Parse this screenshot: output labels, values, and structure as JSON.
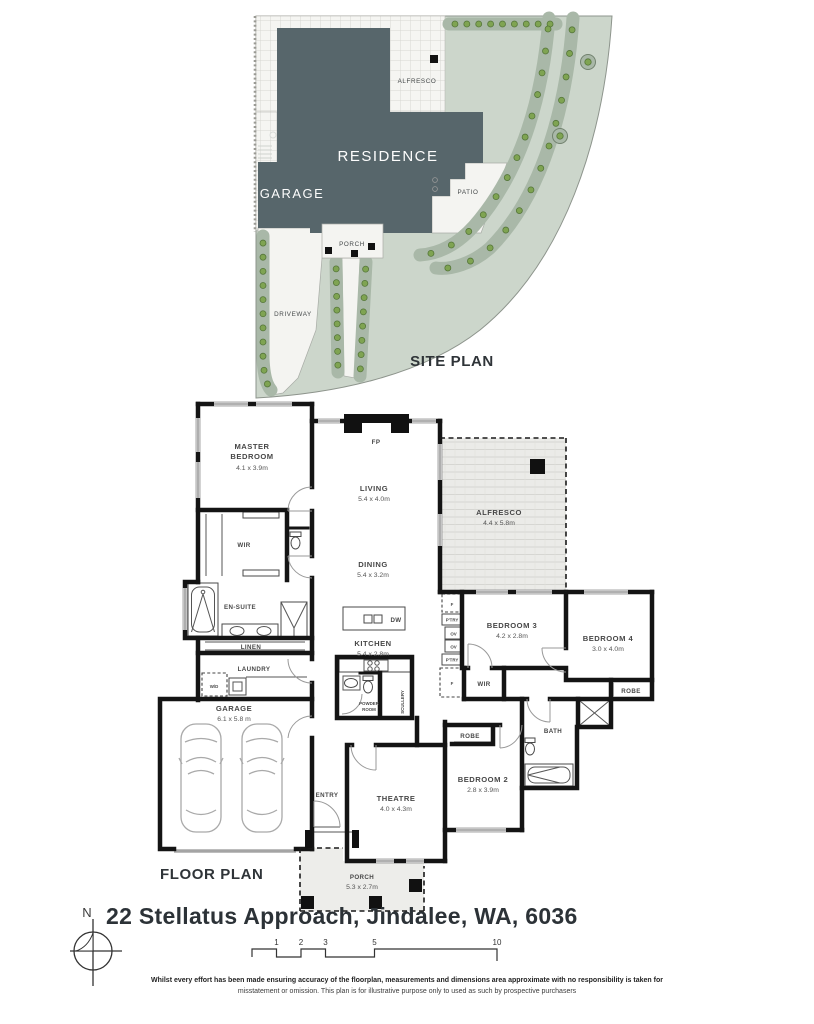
{
  "site": {
    "title": "SITE PLAN",
    "labels": {
      "alfresco": "ALFRESCO",
      "residence": "RESIDENCE",
      "garage": "GARAGE",
      "patio": "PATIO",
      "porch": "PORCH",
      "driveway": "DRIVEWAY"
    }
  },
  "floor": {
    "title": "FLOOR PLAN",
    "labels": {
      "master1": "MASTER",
      "master2": "BEDROOM",
      "master_d": "4.1 x 3.9m",
      "wir": "WIR",
      "ensuite": "EN-SUITE",
      "linen": "LINEN",
      "laundry": "LAUNDRY",
      "wd": "W/D",
      "garage": "GARAGE",
      "garage_d": "6.1 x 5.8 m",
      "living": "LIVING",
      "living_d": "5.4 x 4.0m",
      "dining": "DINING",
      "dining_d": "5.4 x 3.2m",
      "kitchen": "KITCHEN",
      "kitchen_d": "5.4 x 2.8m",
      "dw": "DW",
      "fp": "FP",
      "powder1": "POWDER",
      "powder2": "ROOM",
      "scullery": "SCULLERY",
      "alfresco": "ALFRESCO",
      "alfresco_d": "4.4 x 5.8m",
      "bed3": "BEDROOM 3",
      "bed3_d": "4.2 x 2.8m",
      "bed4": "BEDROOM 4",
      "bed4_d": "3.0 x 4.0m",
      "robe4": "ROBE",
      "f_top": "F",
      "ptry_top": "P'TRY",
      "ov1": "OV",
      "ov2": "OV",
      "ptry_bot": "P'TRY",
      "f_bot": "F",
      "wir2": "WIR",
      "bath": "BATH",
      "robe2": "ROBE",
      "bed2": "BEDROOM 2",
      "bed2_d": "2.8 x 3.9m",
      "entry": "ENTRY",
      "theatre": "THEATRE",
      "theatre_d": "4.0 x 4.3m",
      "porch": "PORCH",
      "porch_d": "5.3 x 2.7m"
    }
  },
  "footer": {
    "north": "N",
    "address": "22 Stellatus Approach, Jindalee, WA, 6036",
    "scale_ticks": [
      "1",
      "2",
      "3",
      "5",
      "10"
    ],
    "disclaimer1": "Whilst every effort has been made ensuring accuracy of the floorplan, measurements and dimensions area approximate with no responsibility is taken for",
    "disclaimer2": "misstatement or omission. This plan is for illustrative purpose only to used as such by prospective purchasers"
  },
  "colors": {
    "residence": "#57666b",
    "lawn": "#ccd6cb",
    "garden_bed": "#a9b8a8",
    "plant": "#7fa452",
    "paving": "#f4f4f1",
    "wall": "#141414",
    "heading_text": "#2f3438"
  }
}
